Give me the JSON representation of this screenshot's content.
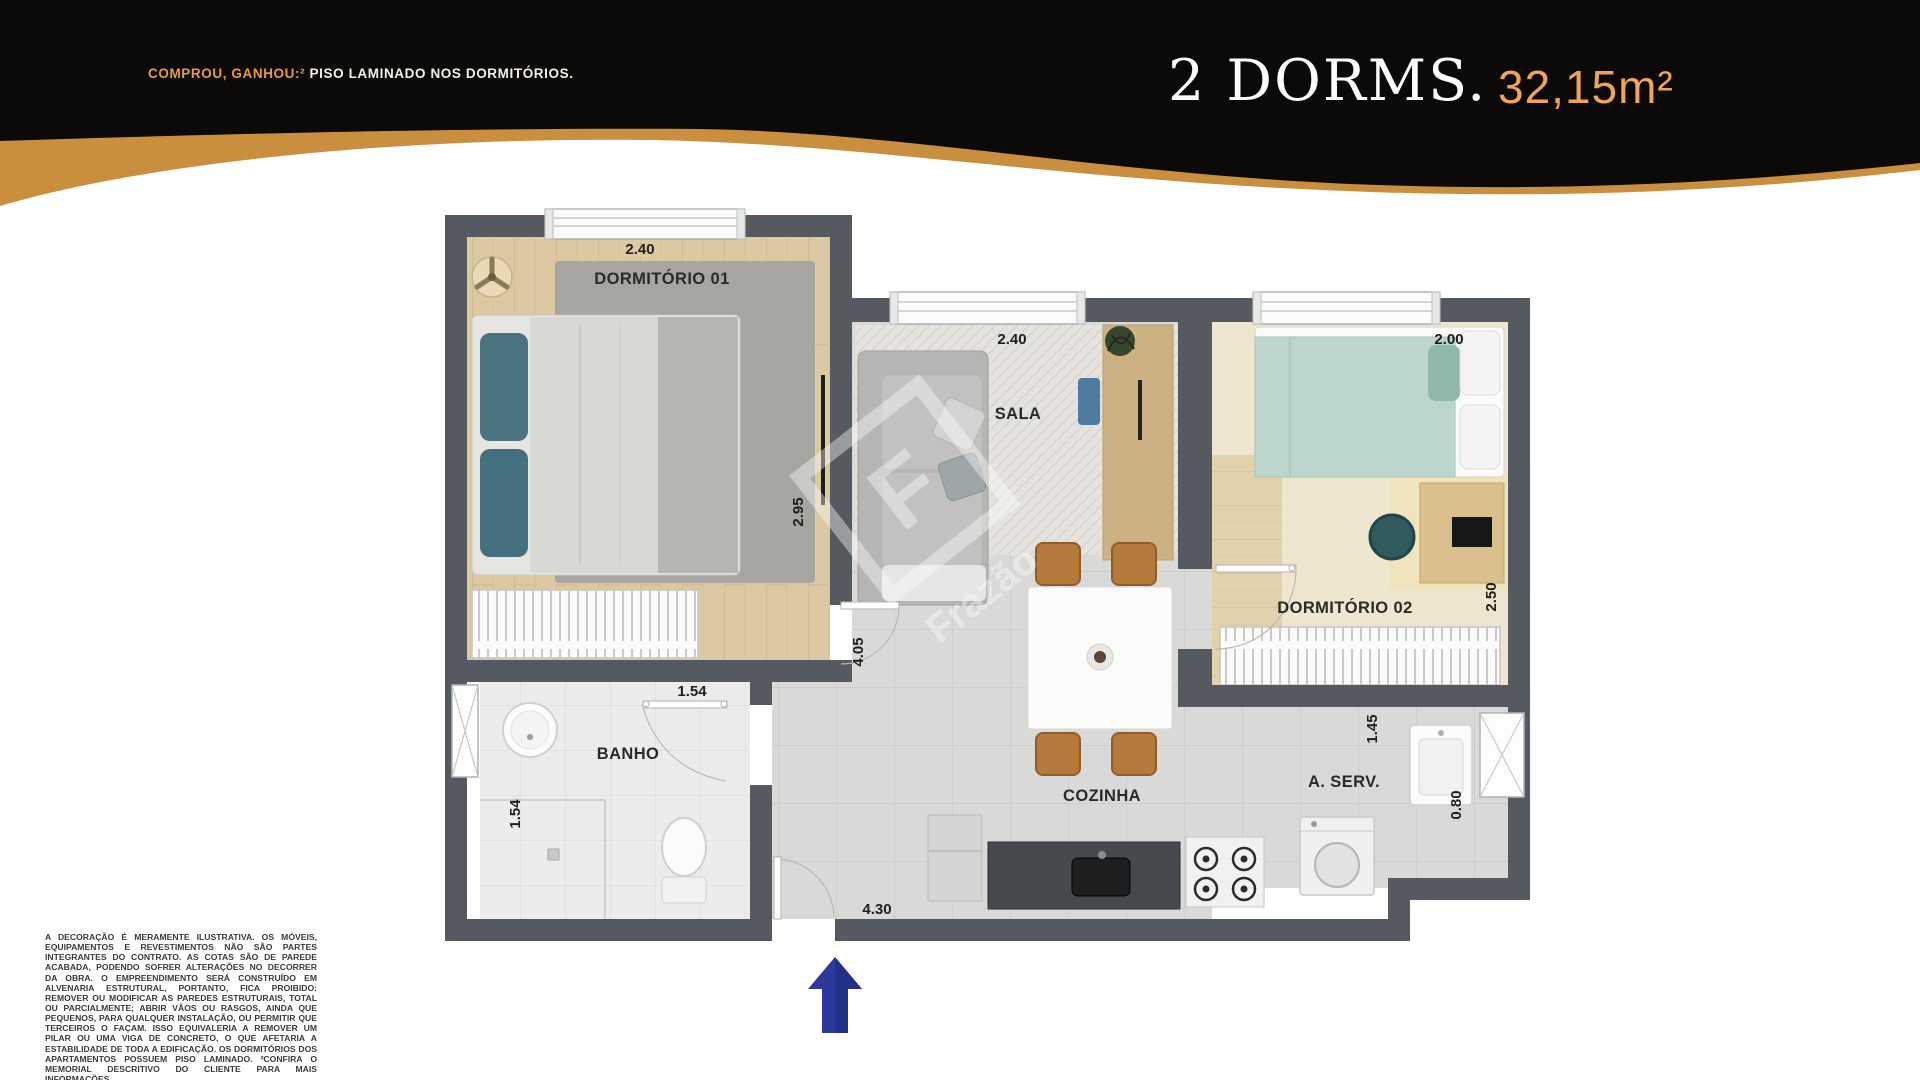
{
  "banner": {
    "promo_highlight": "COMPROU, GANHOU:²",
    "promo_text": " PISO LAMINADO NOS DORMITÓRIOS.",
    "unit_type": "2 DORMS.",
    "unit_area": "32,15m²",
    "colors": {
      "background": "#0c0a08",
      "gold_wave": "#c98f3e",
      "promo_highlight": "#e89c3f",
      "area_text": "#f0a54e"
    }
  },
  "floorplan": {
    "wall_color": "#545a5f",
    "entrance_arrow_color": "#2b3a9c",
    "watermark": {
      "letter": "F",
      "name": "Frazão"
    },
    "rooms": {
      "dorm1": {
        "label": "DORMITÓRIO 01",
        "dim_width": "2.40",
        "dim_depth": "2.95"
      },
      "sala": {
        "label": "SALA",
        "dim_width": "2.40"
      },
      "dorm2": {
        "label": "DORMITÓRIO 02",
        "dim_width": "2.00",
        "dim_depth": "2.50"
      },
      "banho": {
        "label": "BANHO",
        "dim_door": "1.54",
        "dim_depth": "1.54"
      },
      "cozinha": {
        "label": "COZINHA",
        "dim_corridor": "4.05",
        "dim_bottom": "4.30"
      },
      "aserv": {
        "label": "A. SERV.",
        "dim_width": "1.45",
        "dim_depth": "0.80"
      }
    }
  },
  "disclaimer": "A DECORAÇÃO É MERAMENTE ILUSTRATIVA. OS MÓVEIS, EQUIPAMENTOS E REVESTIMENTOS NÃO SÃO PARTES INTEGRANTES DO CONTRATO. AS COTAS SÃO DE PAREDE ACABADA, PODENDO SOFRER ALTERAÇÕES NO DECORRER DA OBRA. O EMPREENDIMENTO SERÁ CONSTRUÍDO EM ALVENARIA ESTRUTURAL, PORTANTO, FICA PROIBIDO: REMOVER OU MODIFICAR AS PAREDES ESTRUTURAIS, TOTAL OU PARCIALMENTE; ABRIR VÃOS OU RASGOS, AINDA QUE PEQUENOS, PARA QUALQUER INSTALAÇÃO, OU PERMITIR QUE TERCEIROS O FAÇAM. ISSO EQUIVALERIA A REMOVER UM PILAR OU UMA VIGA DE CONCRETO, O QUE AFETARIA A ESTABILIDADE DE TODA A EDIFICAÇÃO. OS DORMITÓRIOS DOS APARTAMENTOS POSSUEM PISO LAMINADO. ²CONFIRA O MEMORIAL DESCRITIVO DO CLIENTE PARA MAIS INFORMAÇÕES."
}
